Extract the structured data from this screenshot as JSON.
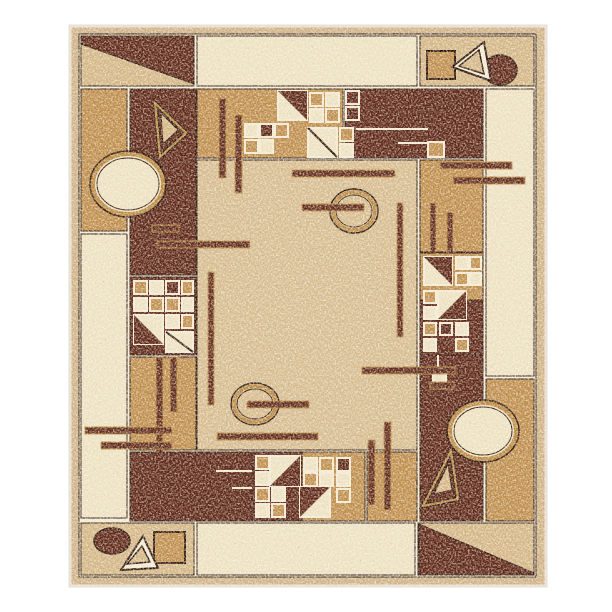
{
  "image": {
    "alt": "Product photo of a rectangular area rug with an abstract geometric Bauhaus-style pattern in dark maroon brown, gold tan, beige and cream speckled pile; motifs include ellipses, double-outline triangles, squares, circles, thin bars and patchwork quilt grids",
    "subject": "area rug",
    "style": "abstract geometric / Bauhaus",
    "background": "white"
  },
  "colors": {
    "border": "#cdb184",
    "lattice": "#f2e9d1",
    "cream": "#ece0c0",
    "field": "#d5ba8d",
    "beige": "#d2b483",
    "tan": "#bd8b49",
    "dark": "#5b2414",
    "darkline": "#2b1408",
    "bar": "#5e2815",
    "gold": "#b8863e",
    "binding": "#e9dfd3"
  },
  "motifs": {
    "corner_top_left": "dark block split by diagonal with beige triangle",
    "corner_top_right": "tan square, double-outline triangle, dark circle",
    "corner_bottom_left": "dark circle, double-outline triangle, tan square",
    "corner_bottom_right": "diagonal split block, dark below",
    "ellipses": "two large cream ellipses with gold rings, two small ring circles with bars",
    "quilt_grids": 4,
    "thin_bars": "horizontal and vertical accent bars across field"
  }
}
